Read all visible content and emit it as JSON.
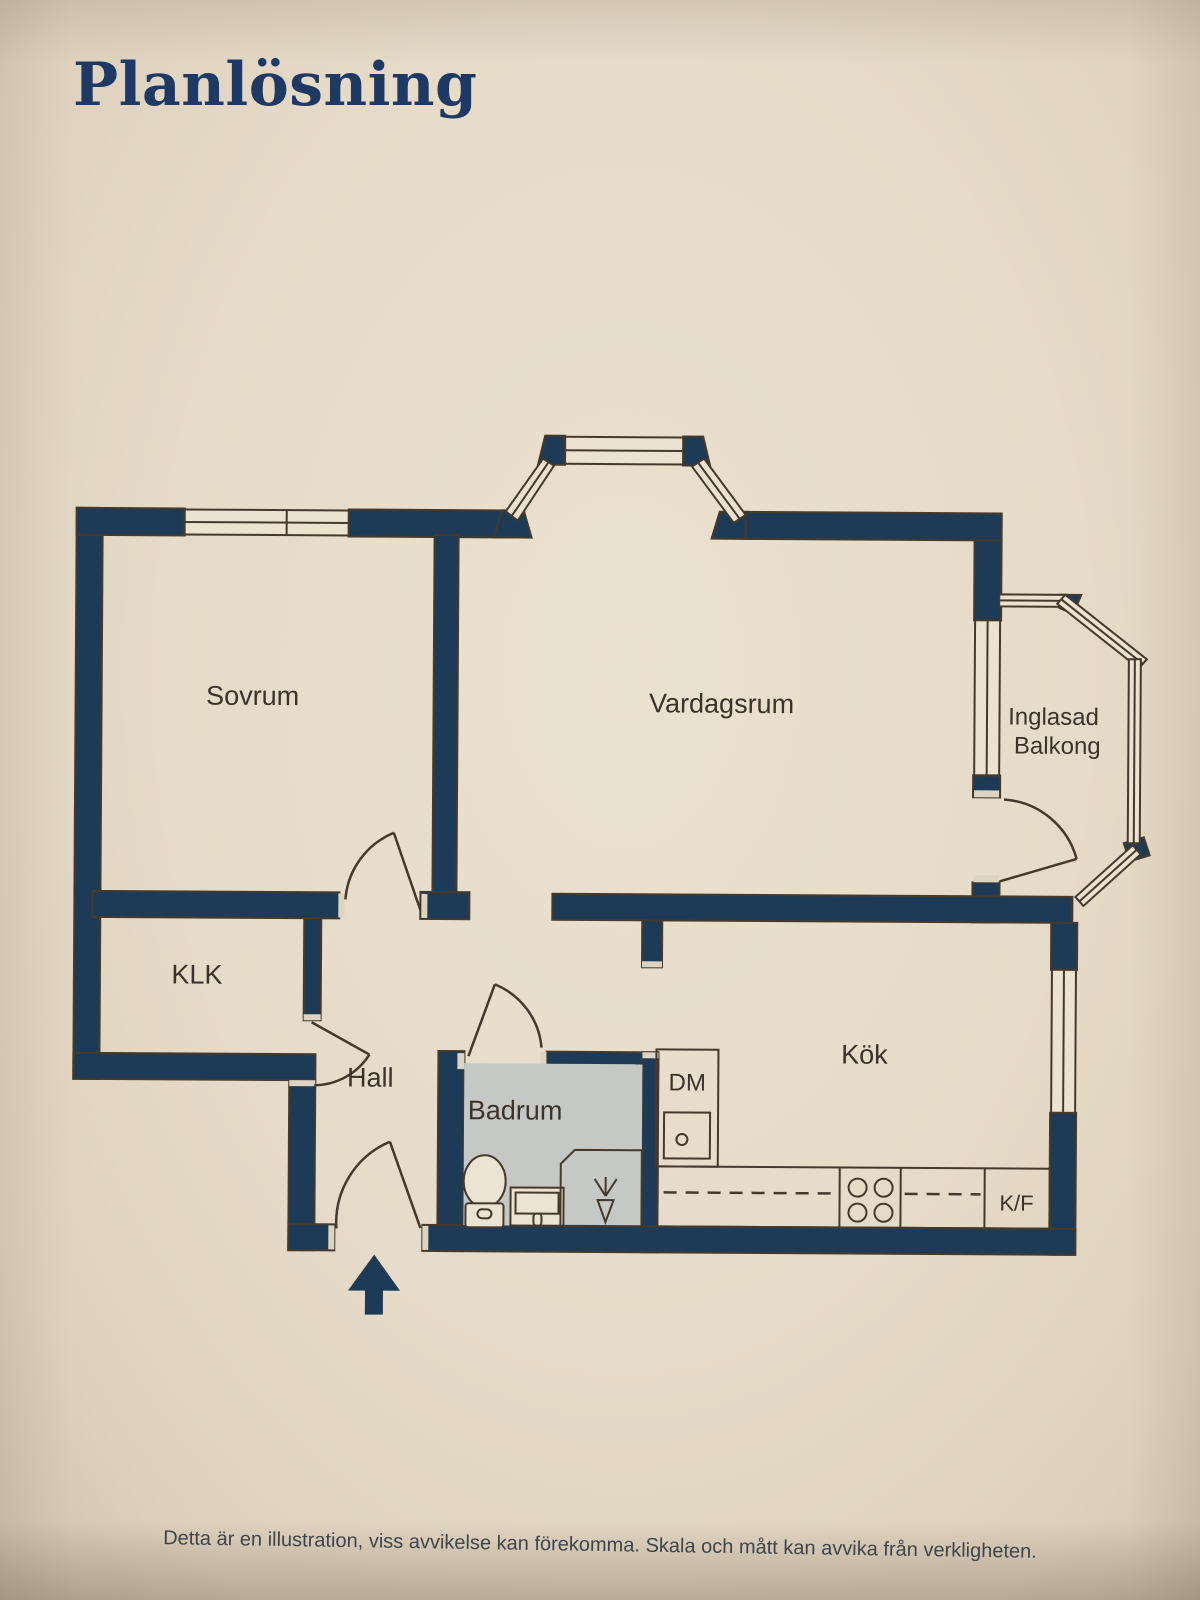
{
  "page": {
    "title": "Planlösning",
    "disclaimer": "Detta är en illustration, viss avvikelse kan förekomma. Skala och mått kan avvika från verkligheten."
  },
  "floorplan": {
    "labels": {
      "sovrum": "Sovrum",
      "vardagsrum": "Vardagsrum",
      "balkong_line1": "Inglasad",
      "balkong_line2": "Balkong",
      "klk": "KLK",
      "hall": "Hall",
      "badrum": "Badrum",
      "kok": "Kök",
      "dm": "DM",
      "kf": "K/F"
    },
    "features": {
      "entrance": "entrance-arrow",
      "doors": 5,
      "windows": 3,
      "glazed_bay_segments": 4
    }
  },
  "colors": {
    "wall": "#1d3b56",
    "background": "#e6dbc8",
    "window": "#ece2d0",
    "bathroom_floor": "#c5c8c5",
    "outline": "#45392c",
    "title": "#1e3a64",
    "label": "#3b332a",
    "footer": "#3e454b"
  }
}
